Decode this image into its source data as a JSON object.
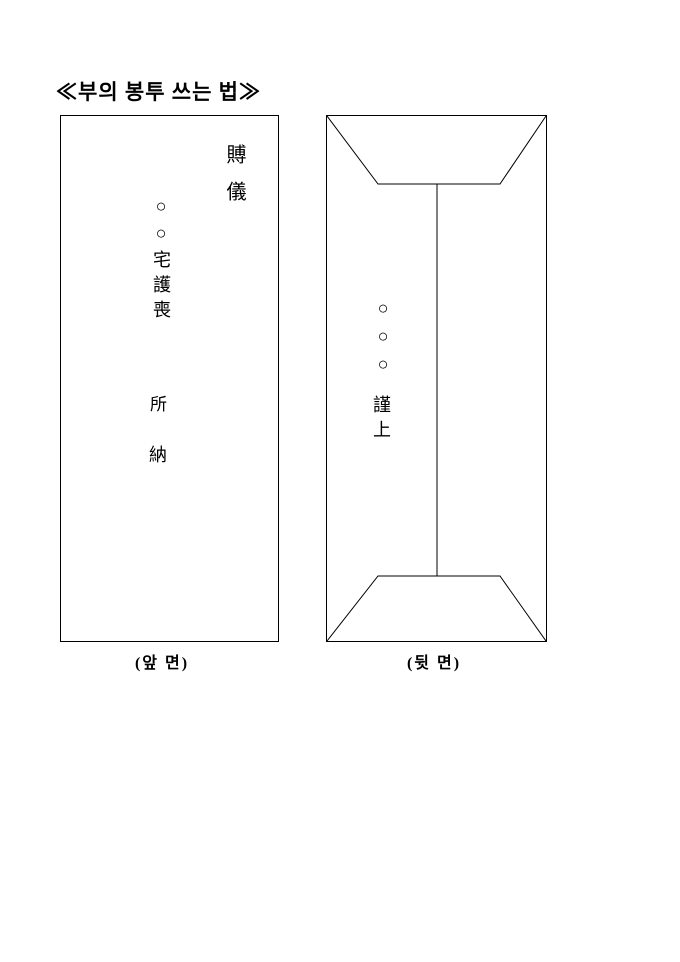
{
  "title": "≪부의 봉투 쓰는 법≫",
  "colors": {
    "ink": "#000000",
    "paper": "#ffffff"
  },
  "front_envelope": {
    "caption": "(앞 면)",
    "heading_vertical": "賻儀",
    "address_top": "○○宅護喪",
    "address_mid": "所",
    "address_bottom": "納"
  },
  "back_envelope": {
    "caption": "(뒷 면)",
    "sender_circles": "○○○",
    "sender_sign": "謹上"
  }
}
